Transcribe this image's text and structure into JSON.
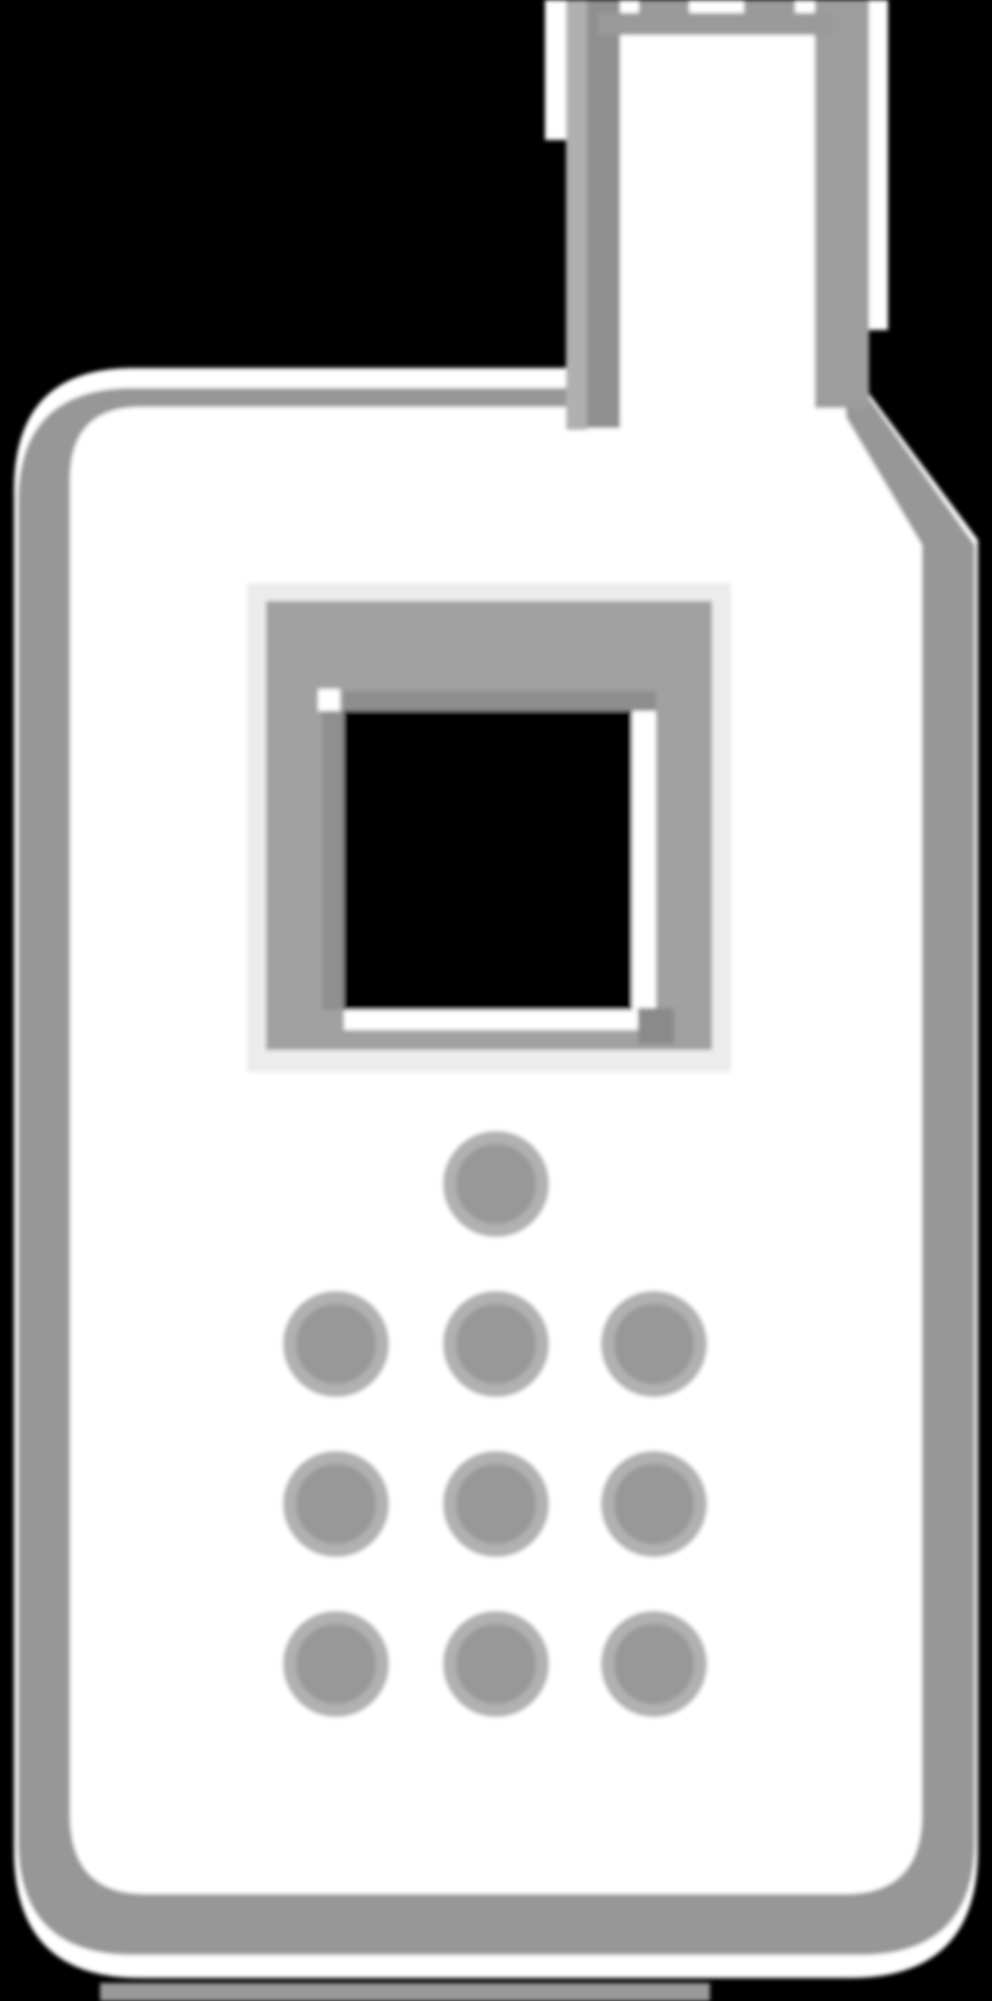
{
  "page": {
    "description": "Pixelated grayscale icon of a classic mobile phone with antenna, screen and keypad dots on a black background",
    "visible_text": ""
  },
  "icon": {
    "name": "mobile-phone-icon",
    "keypad": {
      "dot_outer_radius": 53,
      "dot_core_radius": 40,
      "single_dot": {
        "cx": 496,
        "cy": 1184
      },
      "grid_cols": [
        336,
        496,
        654
      ],
      "grid_rows": [
        1344,
        1504,
        1664
      ],
      "total_dots": 10
    },
    "colors": {
      "background": "#000000",
      "body_fill": "#ffffff",
      "body_outline": "#979797",
      "antenna_interior": "#ffffff",
      "antenna_left_stripe_light": "#b0b0b0",
      "antenna_left_stripe_dark": "#8f8f8f",
      "antenna_right_stripe": "#9d9d9d",
      "antenna_top_bar": "#9a9a9a",
      "antenna_white_sliver": "#ffffff",
      "screen_outer_light": "#ececec",
      "screen_frame": "#a1a1a1",
      "screen_frame_dark": "#8e8e8e",
      "screen_inner_left_dark": "#8f8f8f",
      "screen_white_gap": "#ffffff",
      "screen_notch": "#ffffff",
      "screen_black": "#000000",
      "screen_corner_block": "#8a8a8a",
      "dot_core": "#989898",
      "dot_soft_rim": "#b1b1b1",
      "bottom_strip": "#9a9a9a"
    }
  }
}
